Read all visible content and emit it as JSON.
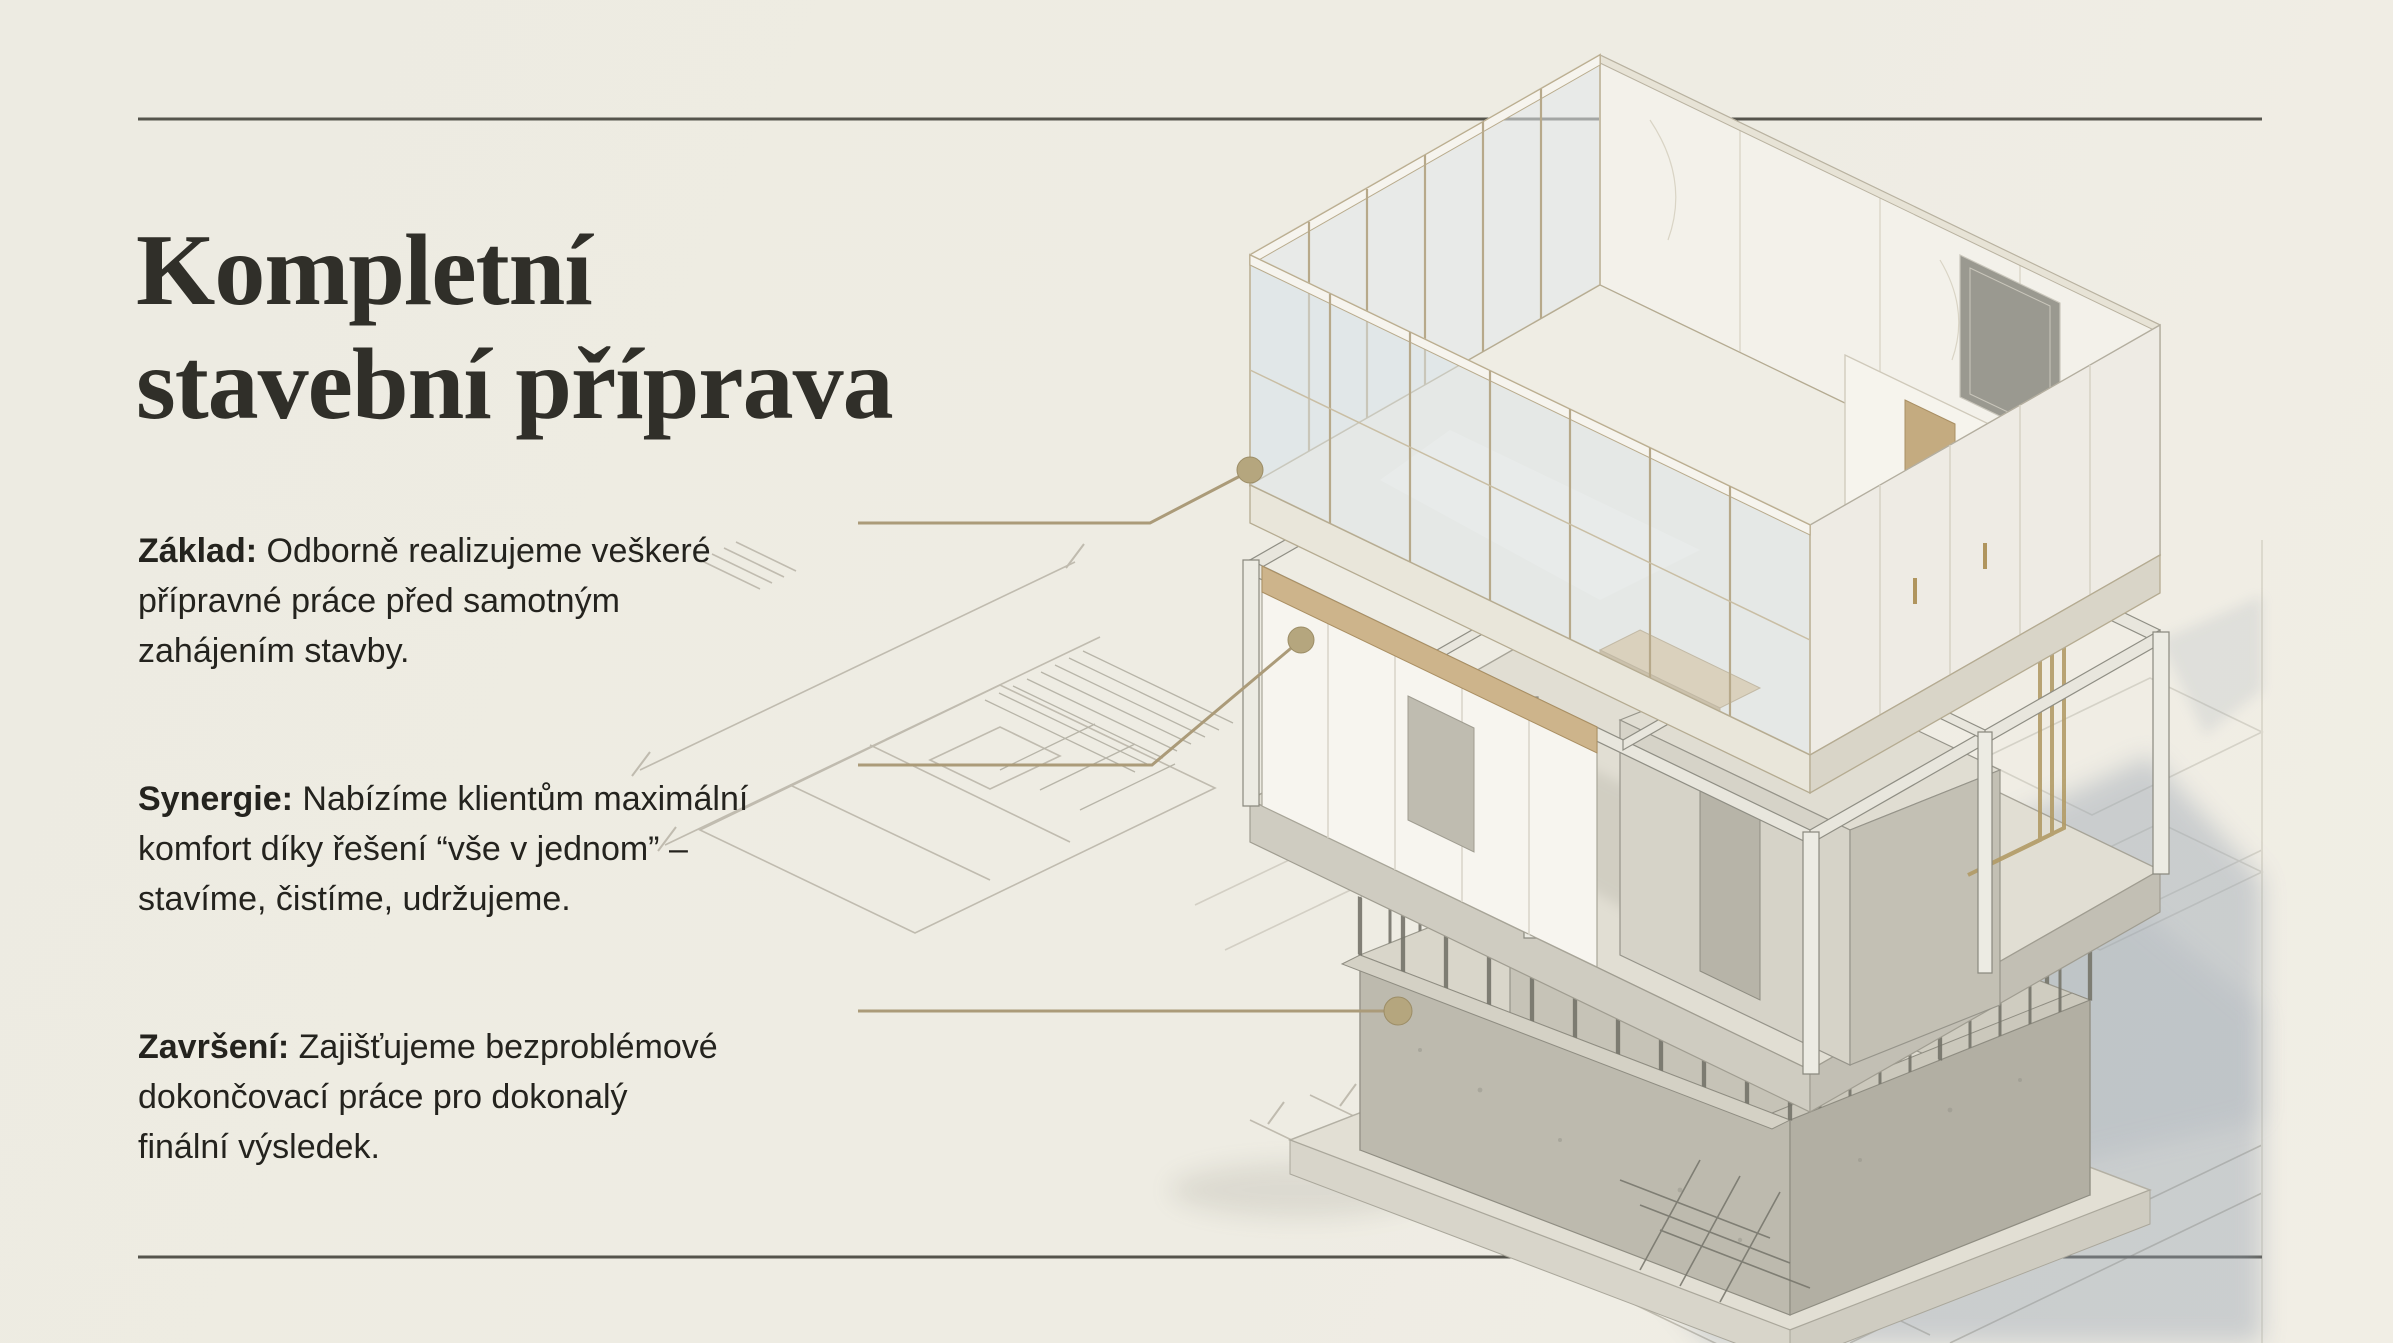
{
  "title": {
    "lines": [
      "Kompletní",
      "stavební příprava"
    ]
  },
  "sections": [
    {
      "id": "zaklad",
      "lead": "Základ:",
      "text": " Odborně realizujeme veškeré\npřípravné práce před samotným\nzahájením stavby."
    },
    {
      "id": "synergie",
      "lead": "Synergie:",
      "text": " Nabízíme klientům maximální\nkomfort díky řešení “vše v jednom” –\nstavíme, čistíme, udržujeme."
    },
    {
      "id": "zavrseni",
      "lead": "Završení:",
      "text": " Zajišťujeme bezproblémové\ndokončovací práce pro dokonalý\nfinální výsledek."
    }
  ],
  "illustration": {
    "type": "exploded-axonometric-building",
    "levels": [
      "glass-interior-level",
      "structural-frame-level",
      "foundation-level"
    ],
    "leader_dots": 3
  },
  "colors": {
    "background": "#edebe2",
    "rule": "#55544c",
    "title_text": "#302f29",
    "body_text": "#24231e",
    "accent_gold": "#ab9b79",
    "gold_dot": "#b5a67e",
    "blueprint_line": "#b7b3a6",
    "shadow_blue": "#97a2b1",
    "marble": "#f3f1ea",
    "concrete": "#cfccc1",
    "wood": "#cdb48b"
  }
}
